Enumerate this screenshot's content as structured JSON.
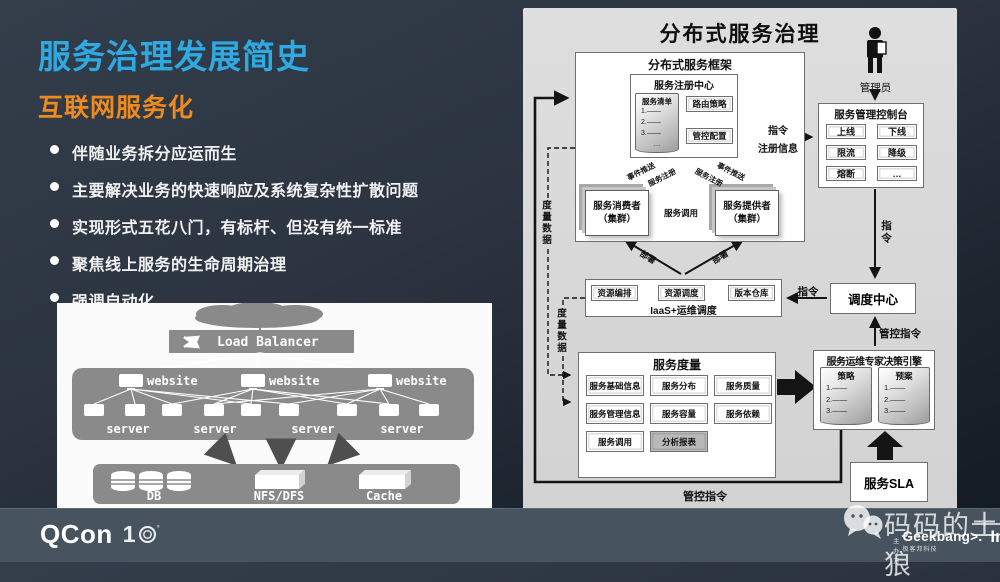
{
  "colors": {
    "title_blue": "#2fa9e1",
    "accent_orange": "#ef8b1e",
    "panel_gray": "#d7d7d7",
    "footer_bar": "#47545f",
    "legacy_gray": "#8a8a8a"
  },
  "slide": {
    "title": "服务治理发展简史",
    "subtitle": "互联网服务化",
    "bullets": [
      "伴随业务拆分应运而生",
      "主要解决业务的快速响应及系统复杂性扩散问题",
      "实现形式五花八门，有标杆、但没有统一标准",
      "聚焦线上服务的生命周期治理",
      "强调自动化"
    ]
  },
  "legacy": {
    "load_balancer": "Load Balancer",
    "website": "website",
    "server": "server",
    "db": "DB",
    "nfs": "NFS/DFS",
    "cache": "Cache"
  },
  "governance": {
    "title": "分布式服务治理",
    "admin": "管理员",
    "framework": {
      "title": "分布式服务框架",
      "registry": {
        "title": "服务注册中心",
        "list_title": "服务清单",
        "list_items": [
          "1.——",
          "2.——",
          "3.——",
          "…"
        ],
        "routing": "路由策略",
        "control": "管控配置"
      },
      "consumer": "服务消费者",
      "consumer_sub": "（集群）",
      "provider": "服务提供者",
      "provider_sub": "（集群）",
      "event_push": "事件推送",
      "service_register": "服务注册",
      "service_call": "服务调用",
      "deploy": "部署"
    },
    "console": {
      "title": "服务管理控制台",
      "buttons": [
        "上线",
        "下线",
        "限流",
        "降级",
        "熔断",
        "…"
      ]
    },
    "iaas": {
      "items": [
        "资源编排",
        "资源调度",
        "版本仓库"
      ],
      "label": "IaaS+运维调度"
    },
    "dispatch": {
      "title": "调度中心"
    },
    "metrics": {
      "title": "服务度量",
      "items": [
        "服务基础信息",
        "服务分布",
        "服务质量",
        "服务管理信息",
        "服务容量",
        "服务依赖",
        "服务调用",
        "分析报表"
      ]
    },
    "decision": {
      "title": "服务运维专家决策引擎",
      "strategy_title": "策略",
      "plan_title": "预案",
      "items": [
        "1.——",
        "2.——",
        "3.——",
        "…"
      ]
    },
    "sla": "服务SLA",
    "labels": {
      "cmd": "指令",
      "reg_info": "注册信息",
      "control_cmd": "管控指令",
      "metric_data": "度量数据"
    }
  },
  "footer": {
    "qcon": "QCon",
    "qcon_year_digit": "1",
    "watermark": "码码的土狼",
    "host_label": "主办方",
    "geekbang": "Geekbang>.",
    "geekbang_sub": "极客邦科技",
    "infoq": "InfoQ"
  }
}
